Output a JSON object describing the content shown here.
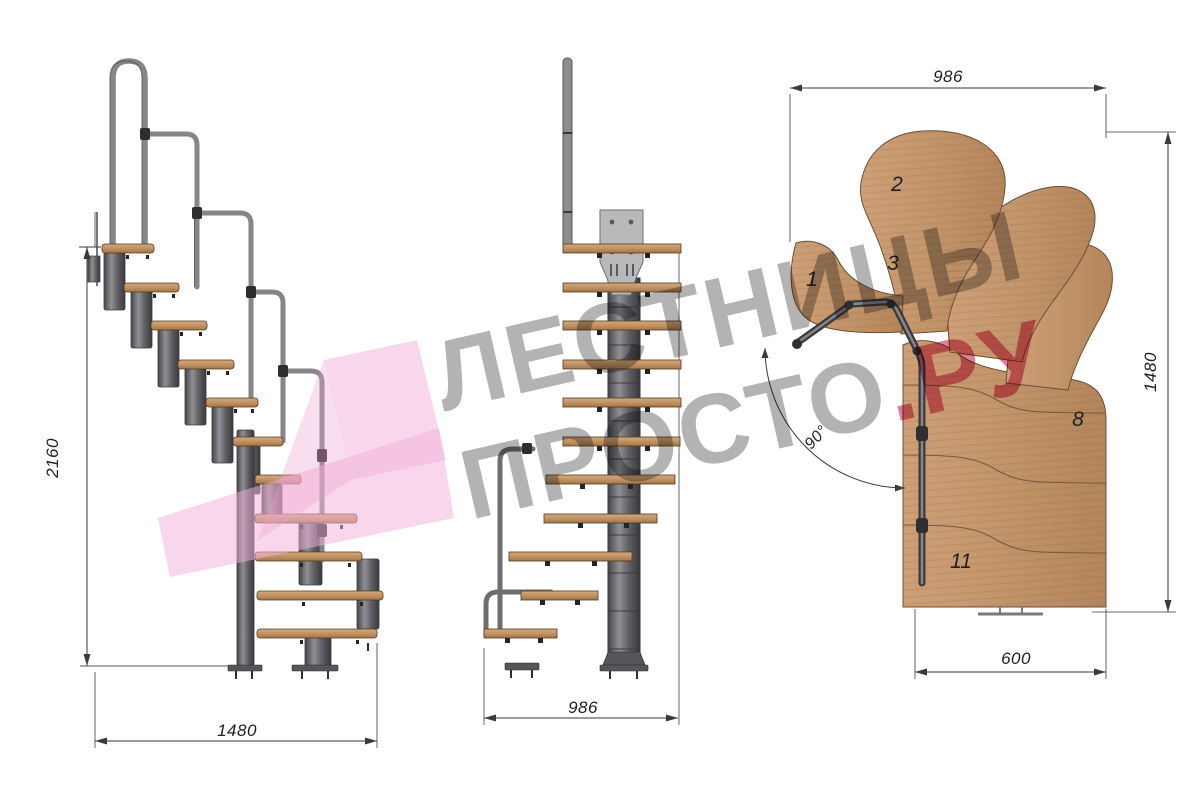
{
  "views": {
    "side": {
      "height_label": "2160",
      "width_label": "1480"
    },
    "front": {
      "width_label": "986"
    },
    "plan": {
      "top_label": "986",
      "right_label": "1480",
      "bottom_label": "600",
      "angle_label": "90°",
      "treads": [
        "1",
        "2",
        "3",
        "8",
        "11"
      ]
    }
  },
  "watermark": {
    "line1": "ЛЕСТНИЦЫ",
    "line2_grey": "ПРОСТО",
    "line2_pink": ".РУ"
  },
  "colors": {
    "wood": "#c2946a",
    "metal": "#6f6f72",
    "rail": "#8a8a8d",
    "dimension_line": "#3a3a3a",
    "watermark_grey": "#a8a8a8",
    "watermark_pink": "#ce2c60",
    "logo_pink": "#f2b3da"
  }
}
